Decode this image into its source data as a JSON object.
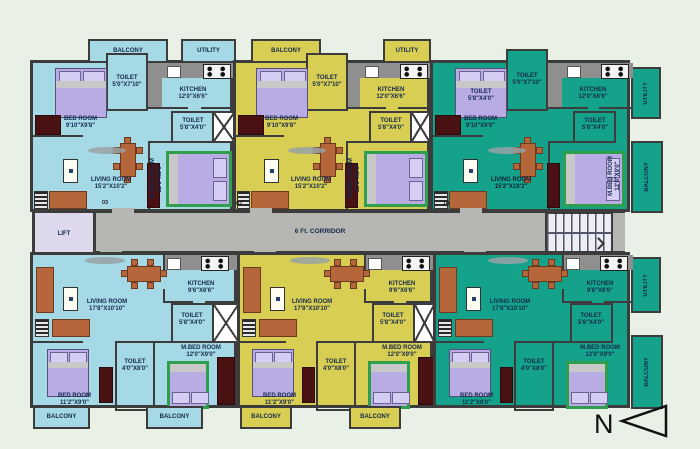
{
  "labels": {
    "balcony": "BALCONY",
    "utility": "UTILITY",
    "lift": "LIFT",
    "corridor": "6 Ft. CORRIDOR",
    "north": "N"
  },
  "top_unit": {
    "bedroom_name": "BED ROOM",
    "bedroom_dims": "9'10\"X9'8\"",
    "toilet_top_name": "TOILET",
    "toilet_top_dims": "5'0\"X7'10\"",
    "kitchen_name": "KITCHEN",
    "kitchen_dims": "12'0\"X6'6\"",
    "toilet_side_name": "TOILET",
    "toilet_side_dims": "5'8\"X4'0\"",
    "living_name": "LIVING ROOM",
    "living_dims": "15'2\"X10'2\"",
    "mbed_name": "M.BED ROOM",
    "mbed_dims": "12'0\"X9'0\""
  },
  "bottom_unit": {
    "living_name": "LIVING ROOM",
    "living_dims": "17'8\"X10'10\"",
    "kitchen_name": "KITCHEN",
    "kitchen_dims": "9'6\"X6'6\"",
    "toilet_side_name": "TOILET",
    "toilet_side_dims": "5'8\"X4'0\"",
    "mbed_name": "M.BED ROOM",
    "mbed_dims": "12'0\"X9'0\"",
    "toilet_mid_name": "TOILET",
    "toilet_mid_dims": "4'0\"X8'0\"",
    "bedroom_name": "BED ROOM",
    "bedroom_dims": "11'2\"X9'0\""
  },
  "bed_overlay": {
    "name": "TOILET",
    "dims": "5'8\"X4'0\""
  },
  "unit_numbers": {
    "u01": "01",
    "u02": "02",
    "u03": "03",
    "u04": "04",
    "u05": "05",
    "u06": "06"
  }
}
